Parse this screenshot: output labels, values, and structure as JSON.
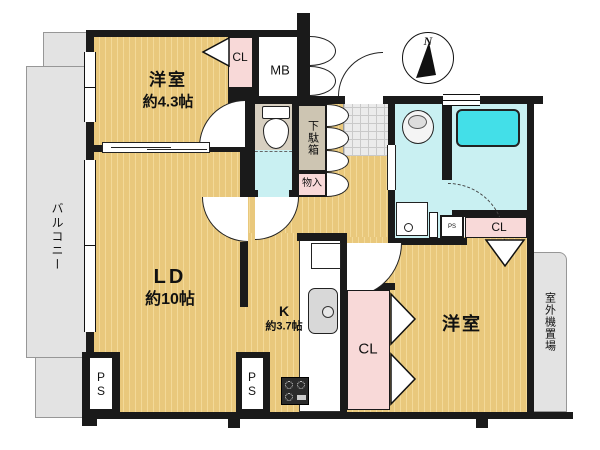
{
  "floorplan": {
    "compass": {
      "north_label": "N"
    },
    "outdoor": {
      "balcony_label": "バルコニー",
      "outdoor_unit_label": "室外機置場"
    },
    "rooms": {
      "bedroom1": {
        "name": "洋室",
        "size": "約4.3帖"
      },
      "living_dining": {
        "name": "LD",
        "size": "約10帖"
      },
      "kitchen": {
        "name": "K",
        "size": "約3.7帖"
      },
      "bedroom2": {
        "name": "洋室"
      }
    },
    "storage": {
      "closet1": "CL",
      "closet2": "CL",
      "closet3": "CL",
      "shoe_cabinet": "下駄箱",
      "storage_box": "物入",
      "meter_box": "MB"
    },
    "pipe_spaces": {
      "ps1": "PS",
      "ps2": "PS",
      "ps3": "PS"
    },
    "colors": {
      "wall_black": "#1a1a1a",
      "floor_tan": "#e9c87c",
      "floor_stripe": "#f3d998",
      "wet_floor_cyan": "#c9f0f2",
      "bathtub_cyan": "#43dfe8",
      "closet_pink": "#f8d9d8",
      "outdoor_gray": "#e3e3e3"
    }
  }
}
